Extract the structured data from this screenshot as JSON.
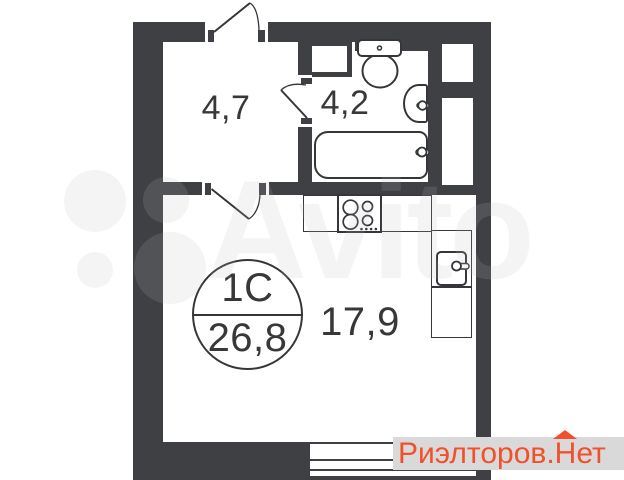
{
  "plan": {
    "background_color": "#ffffff",
    "wall_color": "#3e4043",
    "line_color": "#35363a",
    "label_color": "#38383a",
    "rooms": [
      {
        "id": "hallway",
        "area_label": "4,7"
      },
      {
        "id": "bathroom",
        "area_label": "4,2"
      },
      {
        "id": "living-kitchen",
        "area_label": "17,9"
      }
    ],
    "unit_badge": {
      "type_label": "1С",
      "total_area_label": "26,8"
    }
  },
  "watermarks": {
    "center_logo": {
      "text": "Avito"
    },
    "bottom_right": {
      "text_prefix": "Риэлторов.",
      "house_letter": "Н",
      "text_suffix": "ет",
      "text_color": "#f1502a",
      "band_color": "#d9d9d9"
    }
  }
}
